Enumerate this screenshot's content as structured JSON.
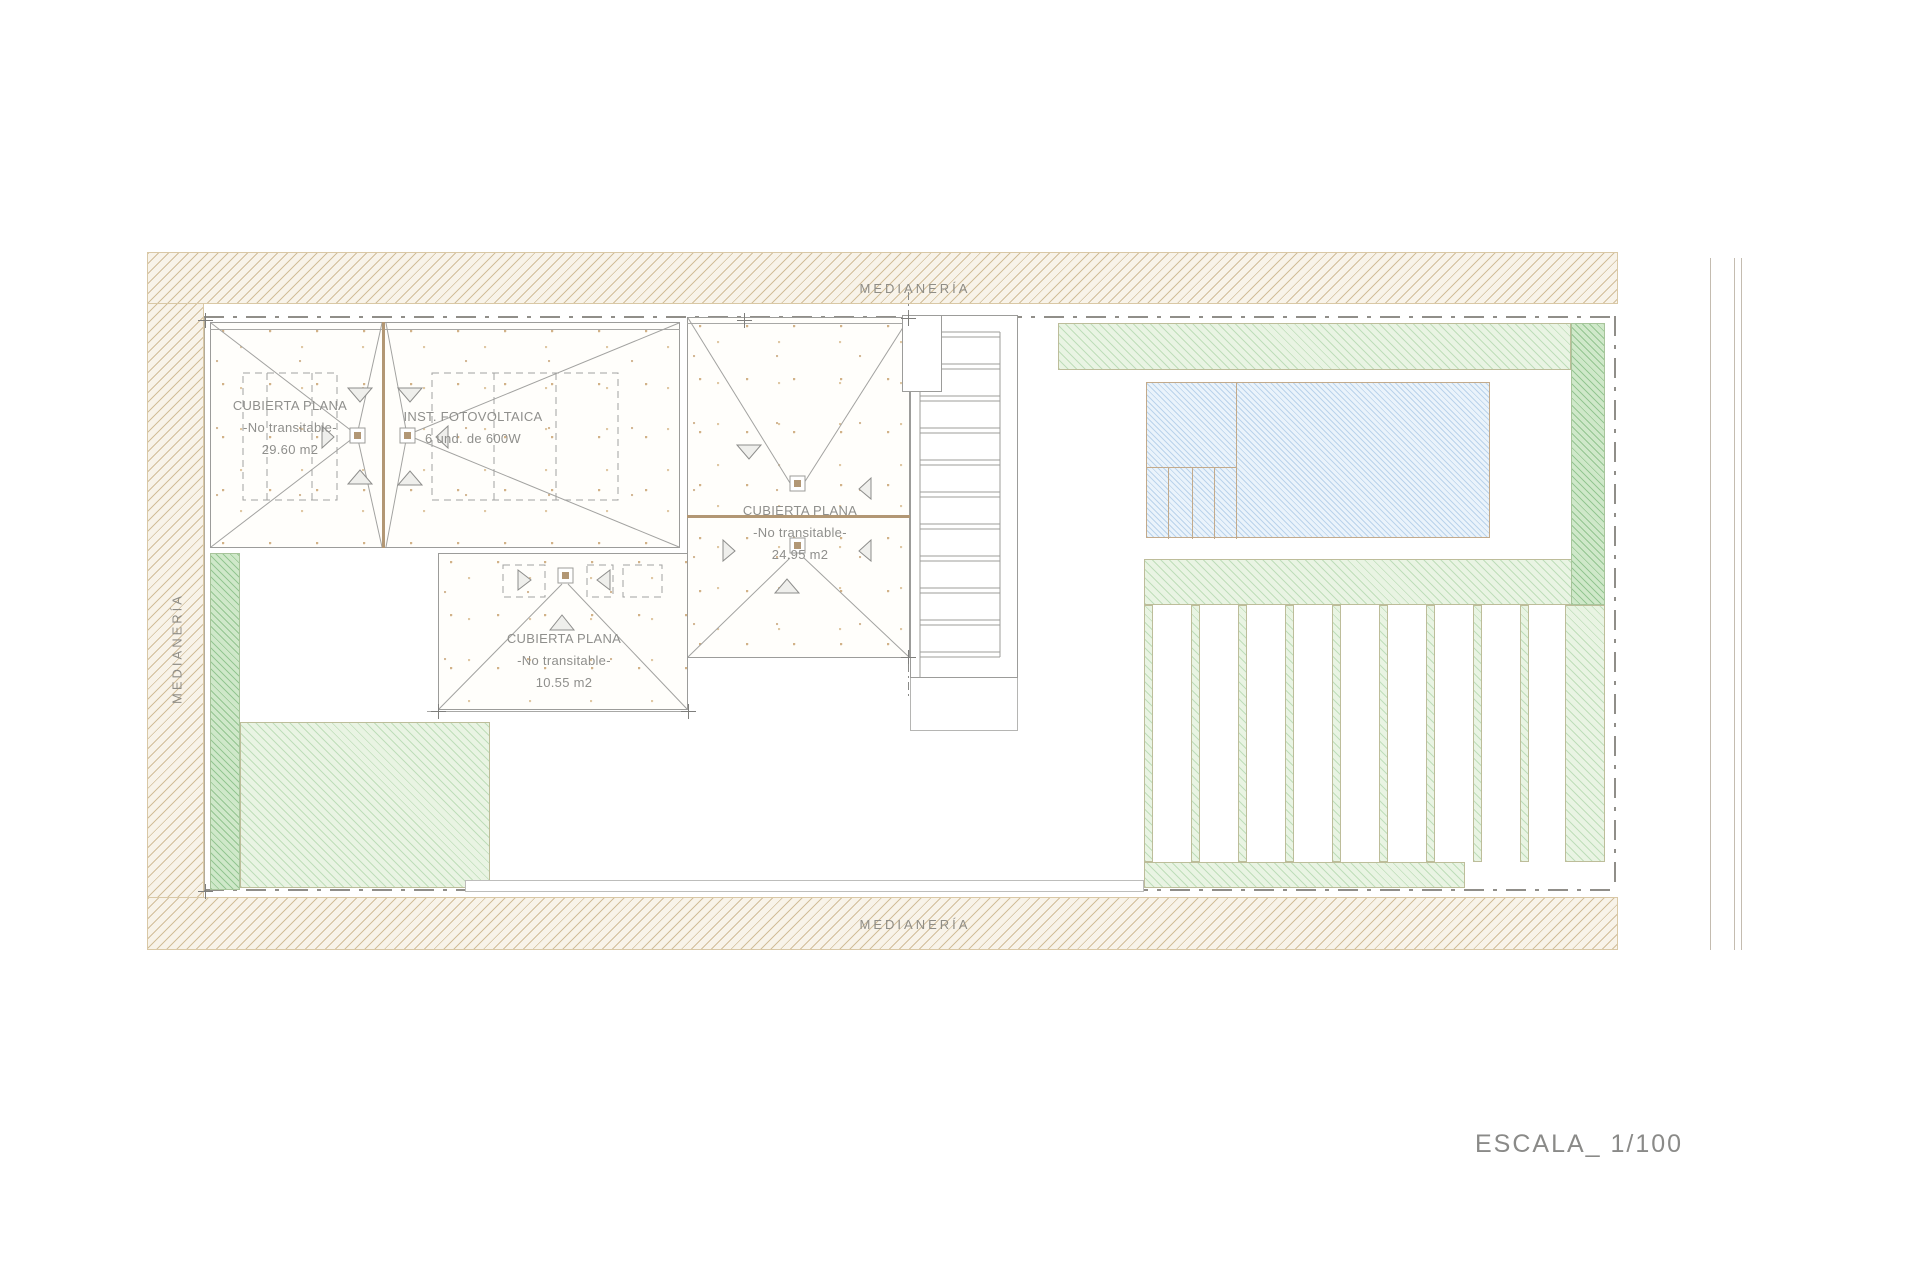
{
  "page": {
    "scale_label": "ESCALA_ 1/100"
  },
  "site": {
    "boundary_top_label": "MEDIANERÍA",
    "boundary_bottom_label": "MEDIANERÍA",
    "boundary_left_label": "MEDIANERÍA"
  },
  "roofs": {
    "roof_main": {
      "title": "CUBIERTA PLANA",
      "subtitle": "-No transitable-",
      "area": "29.60 m2"
    },
    "roof_pv": {
      "title": "INST. FOTOVOLTAICA",
      "subtitle": "6 und. de 600W"
    },
    "roof_center": {
      "title": "CUBIERTA PLANA",
      "subtitle": "-No transitable-",
      "area": "24.95 m2"
    },
    "roof_small": {
      "title": "CUBIERTA PLANA",
      "subtitle": "-No transitable-",
      "area": "10.55 m2"
    }
  },
  "colors": {
    "boundary_hatch_line": "#d4c3a0",
    "roof_outline": "#9c9c9a",
    "ridge_brown": "#b29774",
    "green_light": "#e9f4e3",
    "green_dark": "#cfe8c9",
    "pool_blue": "#eaf3fb",
    "text_gray": "#8f8d86"
  }
}
